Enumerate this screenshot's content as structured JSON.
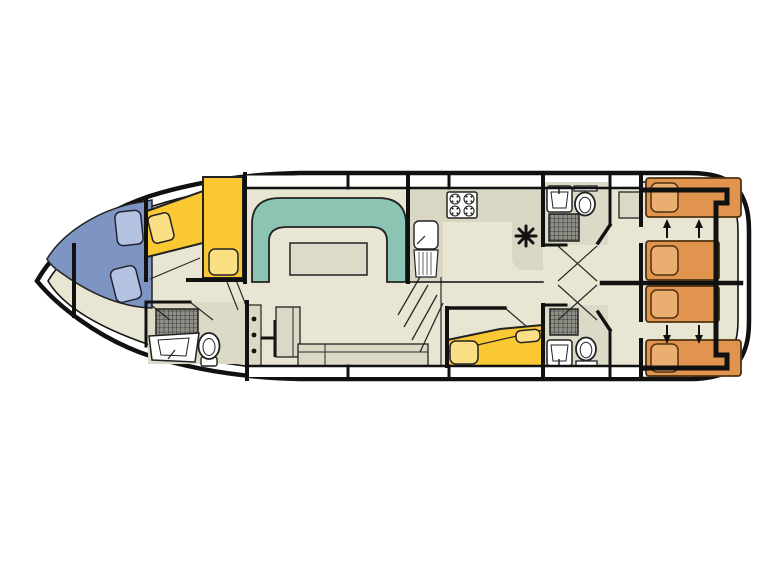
{
  "window": {
    "background": "#ffffff"
  },
  "floor_plan": {
    "kind": "boat-deck-plan-top-view",
    "colors": {
      "outline": "#111111",
      "floor": "#e9e5d3",
      "wet_floor": "#dcd9c7",
      "counter_gray": "#d9d6c4",
      "cabinet_gray": "#dbd8c6",
      "sofa_teal": "#8cc4b4",
      "table_beige": "#dedac8",
      "bed_yellow": "#f9c832",
      "pillow_yellow": "#fbdf85",
      "bed_orange": "#e0944e",
      "pillow_orange": "#eaae70",
      "bench_blue": "#7e95c3",
      "cushion_blue": "#b4c2e2",
      "shower_gray": "#8f8f88",
      "fixture_white": "#ffffff"
    },
    "depicted_elements": {
      "stove_burners": 4,
      "sinks": 4,
      "toilets": 3,
      "showers": 3,
      "stern_single_beds": 4,
      "bed_slide_arrows": 4,
      "bow_seat_cushions": 2,
      "helm_console_knobs": 3,
      "star_marker": 1
    }
  }
}
